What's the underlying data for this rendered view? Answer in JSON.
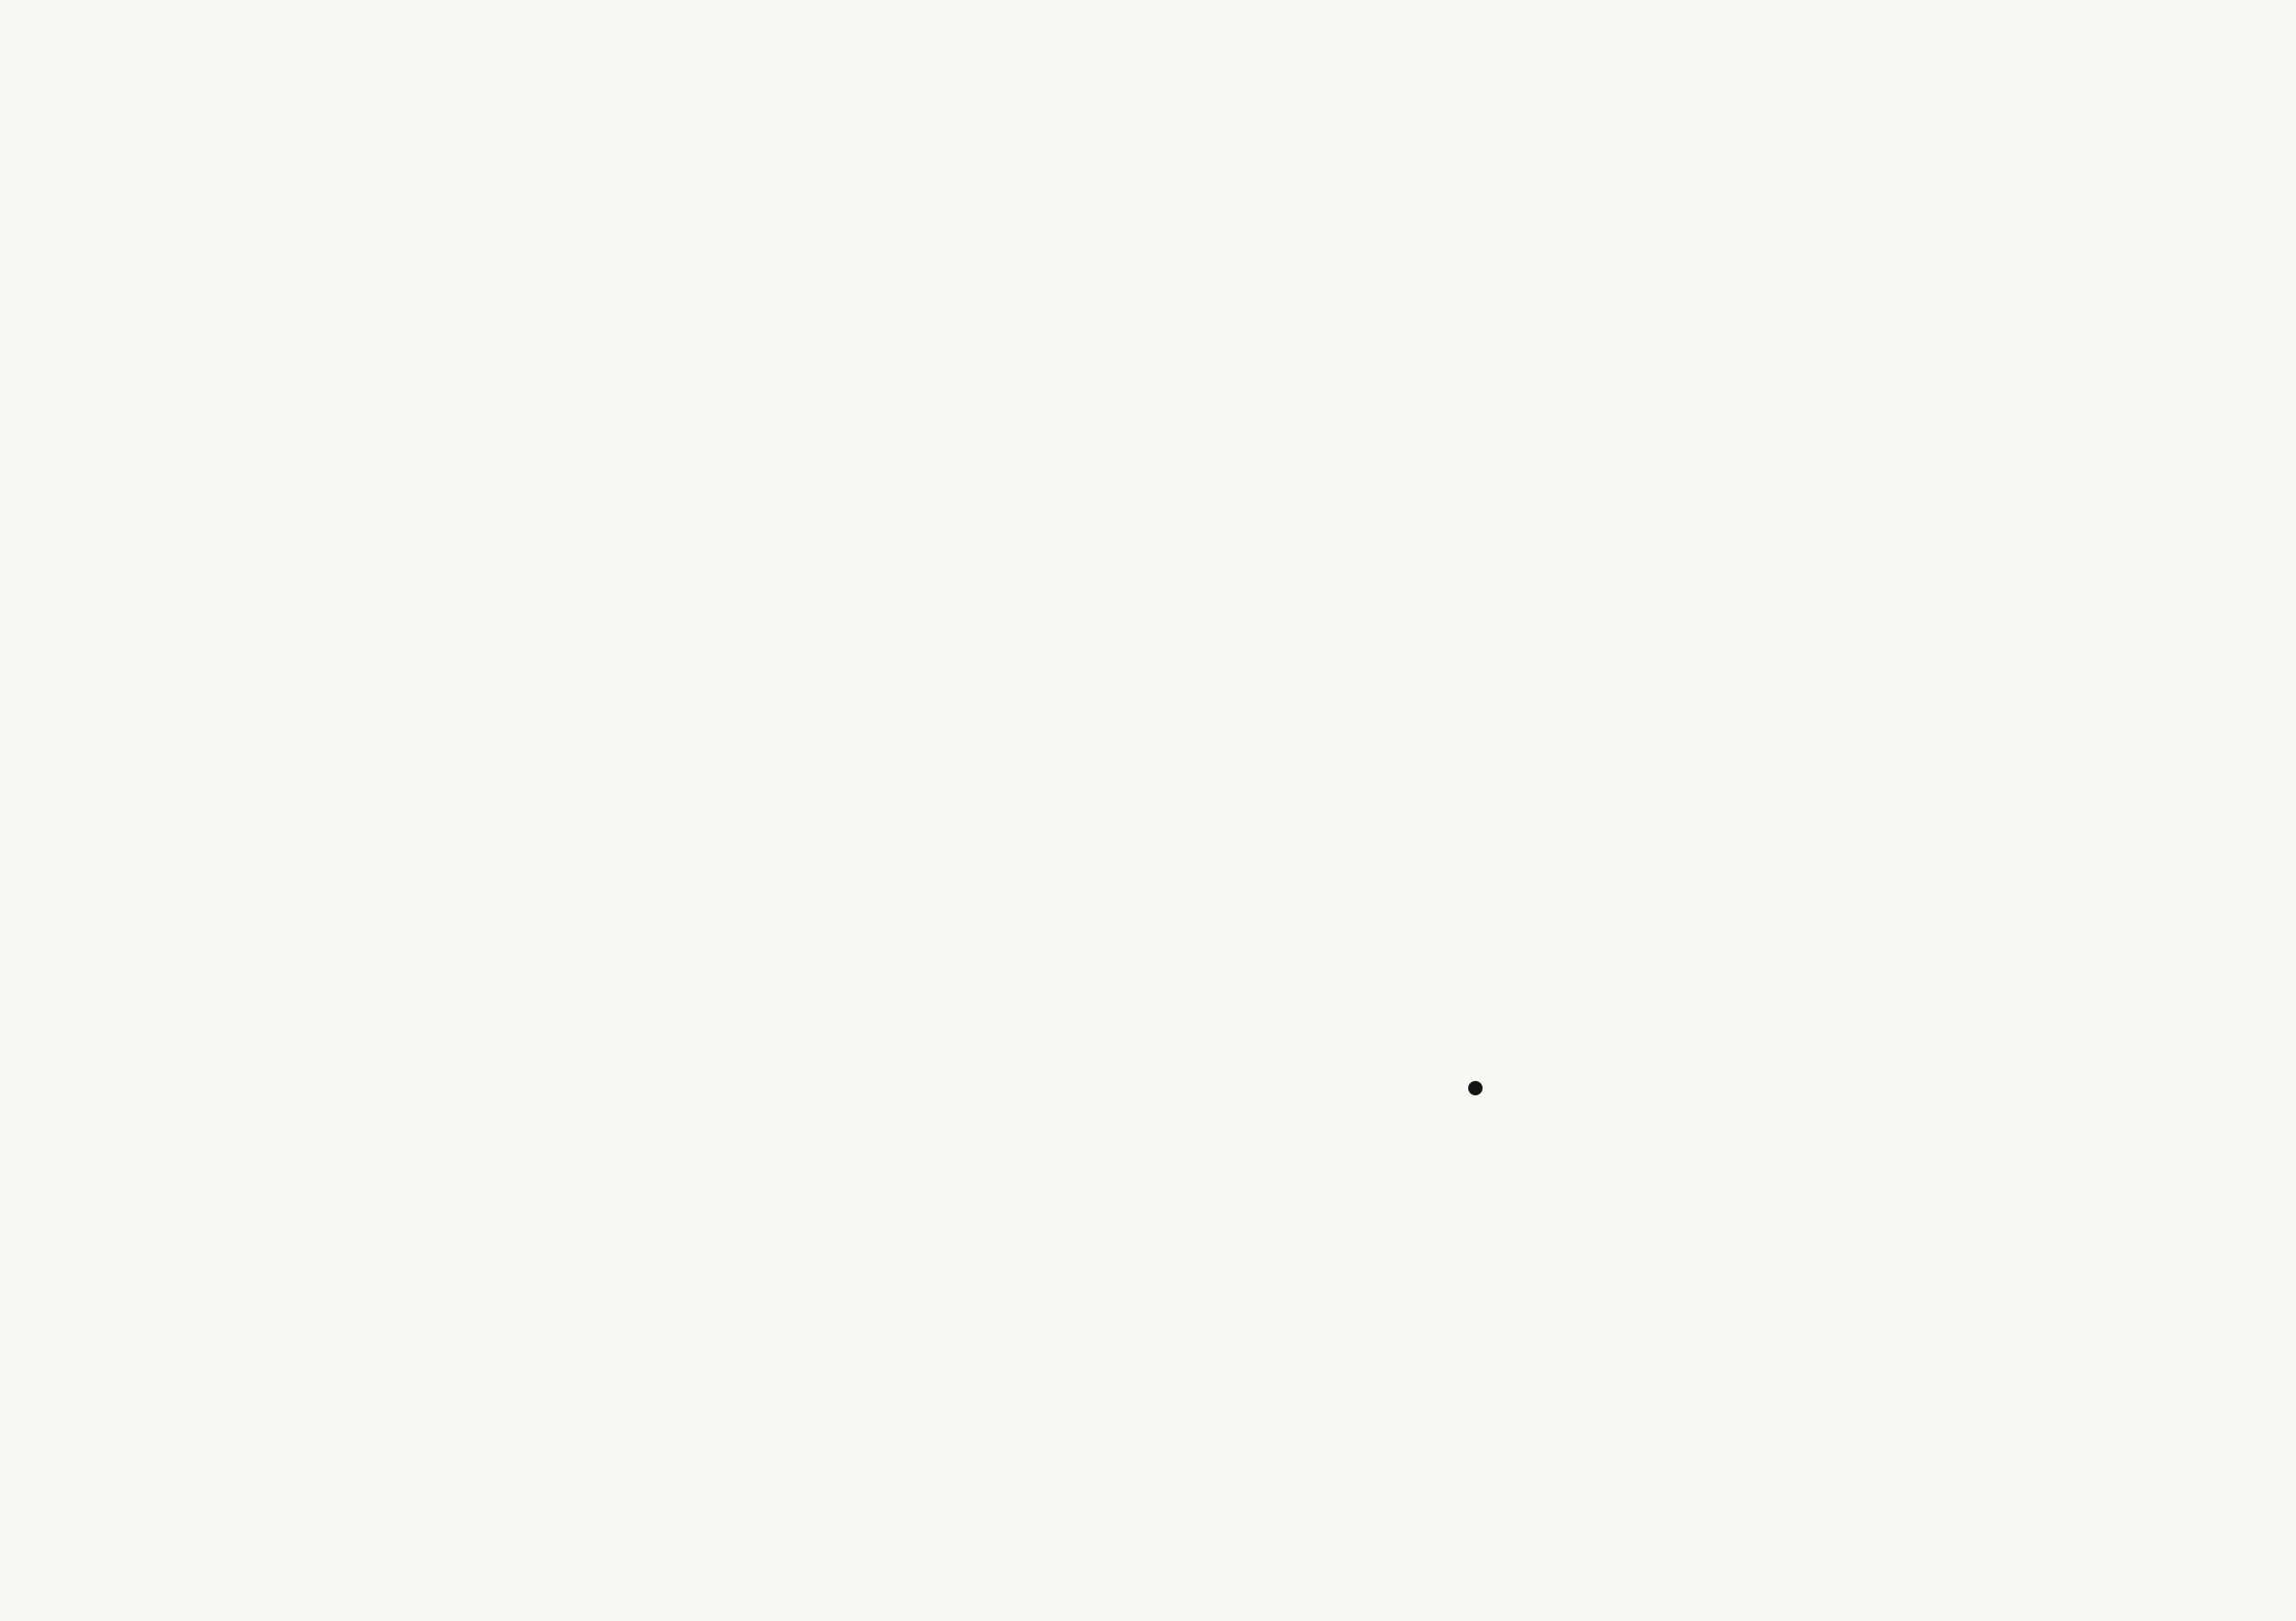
{
  "plan": {
    "stair_up_label": "UP"
  },
  "palette": {
    "wall_green": "#7E9C5D",
    "lawn_green": "#507431",
    "hedge_green": "#476B2B",
    "pale_sage": "#E9EEE0",
    "paper_white": "#F6F8F3",
    "pink_foliage": "#C98DA3",
    "drawing_line_gray": "#6D7268"
  }
}
